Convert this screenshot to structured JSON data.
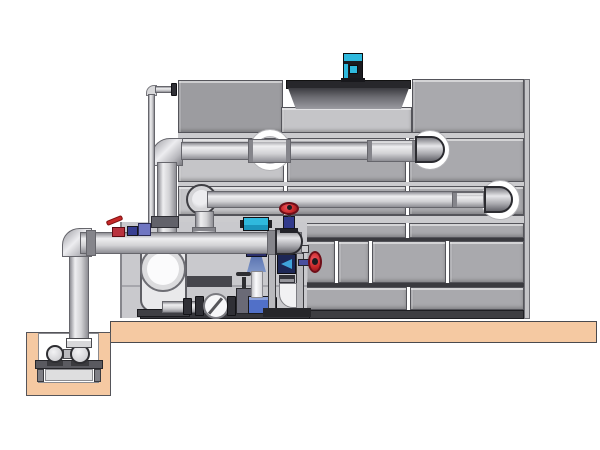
{
  "scene": {
    "type": "technical-illustration",
    "subject": "cooling-tower-with-pump-skid-and-sump-piping",
    "text_content": []
  },
  "palette": {
    "panel": "#a9a9ad",
    "panel_light": "#c5c5c8",
    "panel_dark": "#9c9ca0",
    "joint_dark": "#3a3a3f",
    "sill": "#cbcbce",
    "base_dark": "#3e3e42",
    "basin": "#c9c9cd",
    "concrete": "#f5c9a2",
    "pipe_light": "#eeeef0",
    "pipe_dark": "#8e8e94",
    "cyan": "#2fb9dd",
    "red": "#c62828",
    "navy": "#323a8c",
    "blue_box": "#5170c8",
    "steel_blue": "#7e95c8",
    "frame_gray": "#b9b9bd",
    "cowl_dark": "#27272b"
  },
  "components": {
    "tower": "cooling-tower-panel-casing",
    "fan": "fan-cowl-and-teal-motor",
    "pipes": "supply-and-return-pipes-with-wall-rings",
    "pump": "end-suction-pump",
    "sump": "concrete-pit-with-sump-pump",
    "valves": "red-handwheel-valves-and-lever-valve",
    "feeder": "frame-mounted-feeder-with-drain-elbow",
    "inline_device": "blue-venturi-injection-assembly"
  }
}
